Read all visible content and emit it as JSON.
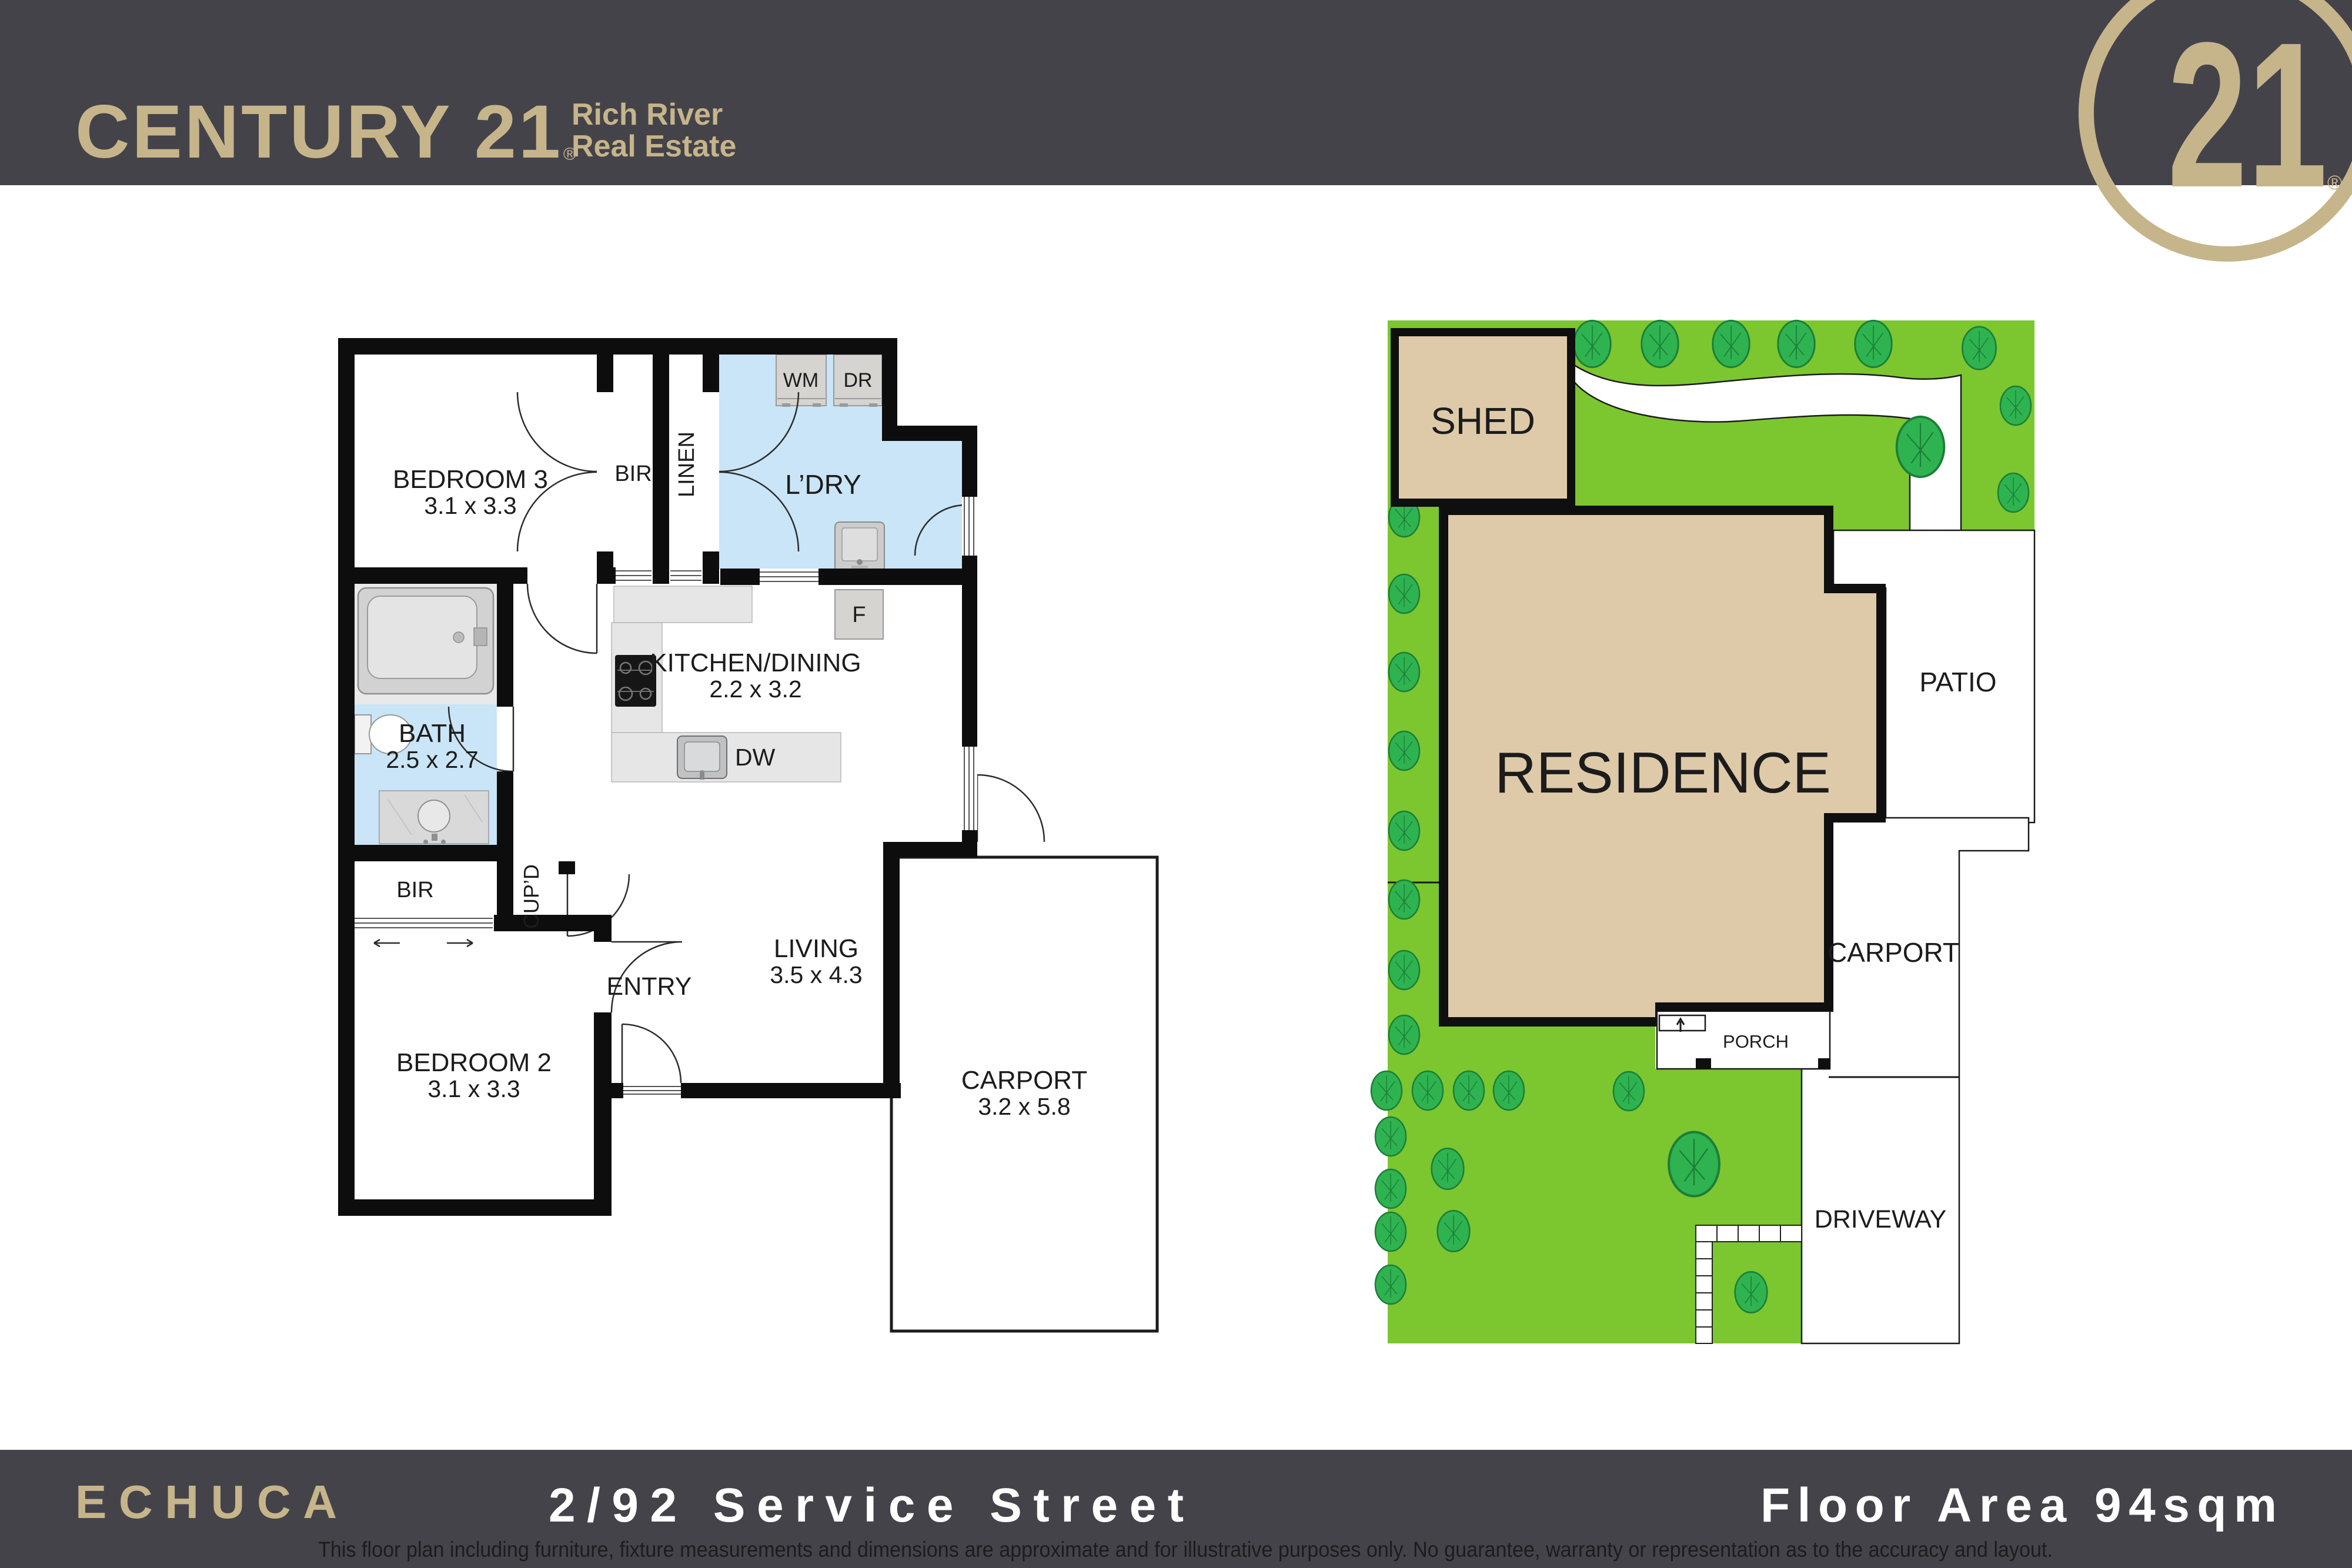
{
  "header": {
    "brand": "CENTURY 21",
    "brand_registered": "®",
    "office_line1": "Rich River",
    "office_line2": "Real Estate",
    "seal_number": "21",
    "seal_registered": "®"
  },
  "floor_plan": {
    "bedroom3": {
      "label": "BEDROOM 3",
      "dim": "3.1 x 3.3"
    },
    "bir1": {
      "label": "BIR"
    },
    "linen": {
      "label": "LINEN"
    },
    "ldry": {
      "label": "L’DRY"
    },
    "wm": {
      "label": "WM"
    },
    "dr": {
      "label": "DR"
    },
    "fridge": {
      "label": "F"
    },
    "dw": {
      "label": "DW"
    },
    "kitchen": {
      "label": "KITCHEN/DINING",
      "dim": "2.2 x 3.2"
    },
    "bath": {
      "label": "BATH",
      "dim": "2.5 x 2.7"
    },
    "bir2": {
      "label": "BIR"
    },
    "cupd": {
      "label": "CUP’D"
    },
    "entry": {
      "label": "ENTRY"
    },
    "living": {
      "label": "LIVING",
      "dim": "3.5 x 4.3"
    },
    "bedroom2": {
      "label": "BEDROOM 2",
      "dim": "3.1 x 3.3"
    },
    "carport": {
      "label": "CARPORT",
      "dim": "3.2 x 5.8"
    }
  },
  "site_plan": {
    "shed": "SHED",
    "residence": "RESIDENCE",
    "patio": "PATIO",
    "carport": "CARPORT",
    "porch": "PORCH",
    "driveway": "DRIVEWAY"
  },
  "footer": {
    "suburb": "ECHUCA",
    "address": "2/92 Service Street",
    "floor_area": "Floor Area 94sqm",
    "disclaimer": "This floor plan including furniture, fixture measurements and dimensions are approximate and for illustrative purposes only. No guarantee, warranty or representation as to the accuracy and layout."
  },
  "colors": {
    "bar": "#45434a",
    "gold": "#c6b58a",
    "white": "#ffffff",
    "plan_blue": "#c9e5f7",
    "wall": "#0d0d0d",
    "counter": "#e6e6e6",
    "appliance": "#d6d4d1",
    "lawn": "#7cc62f",
    "tree": "#2eb350",
    "building": "#decaa9",
    "disclaimer_gold": "#bfae7c"
  }
}
